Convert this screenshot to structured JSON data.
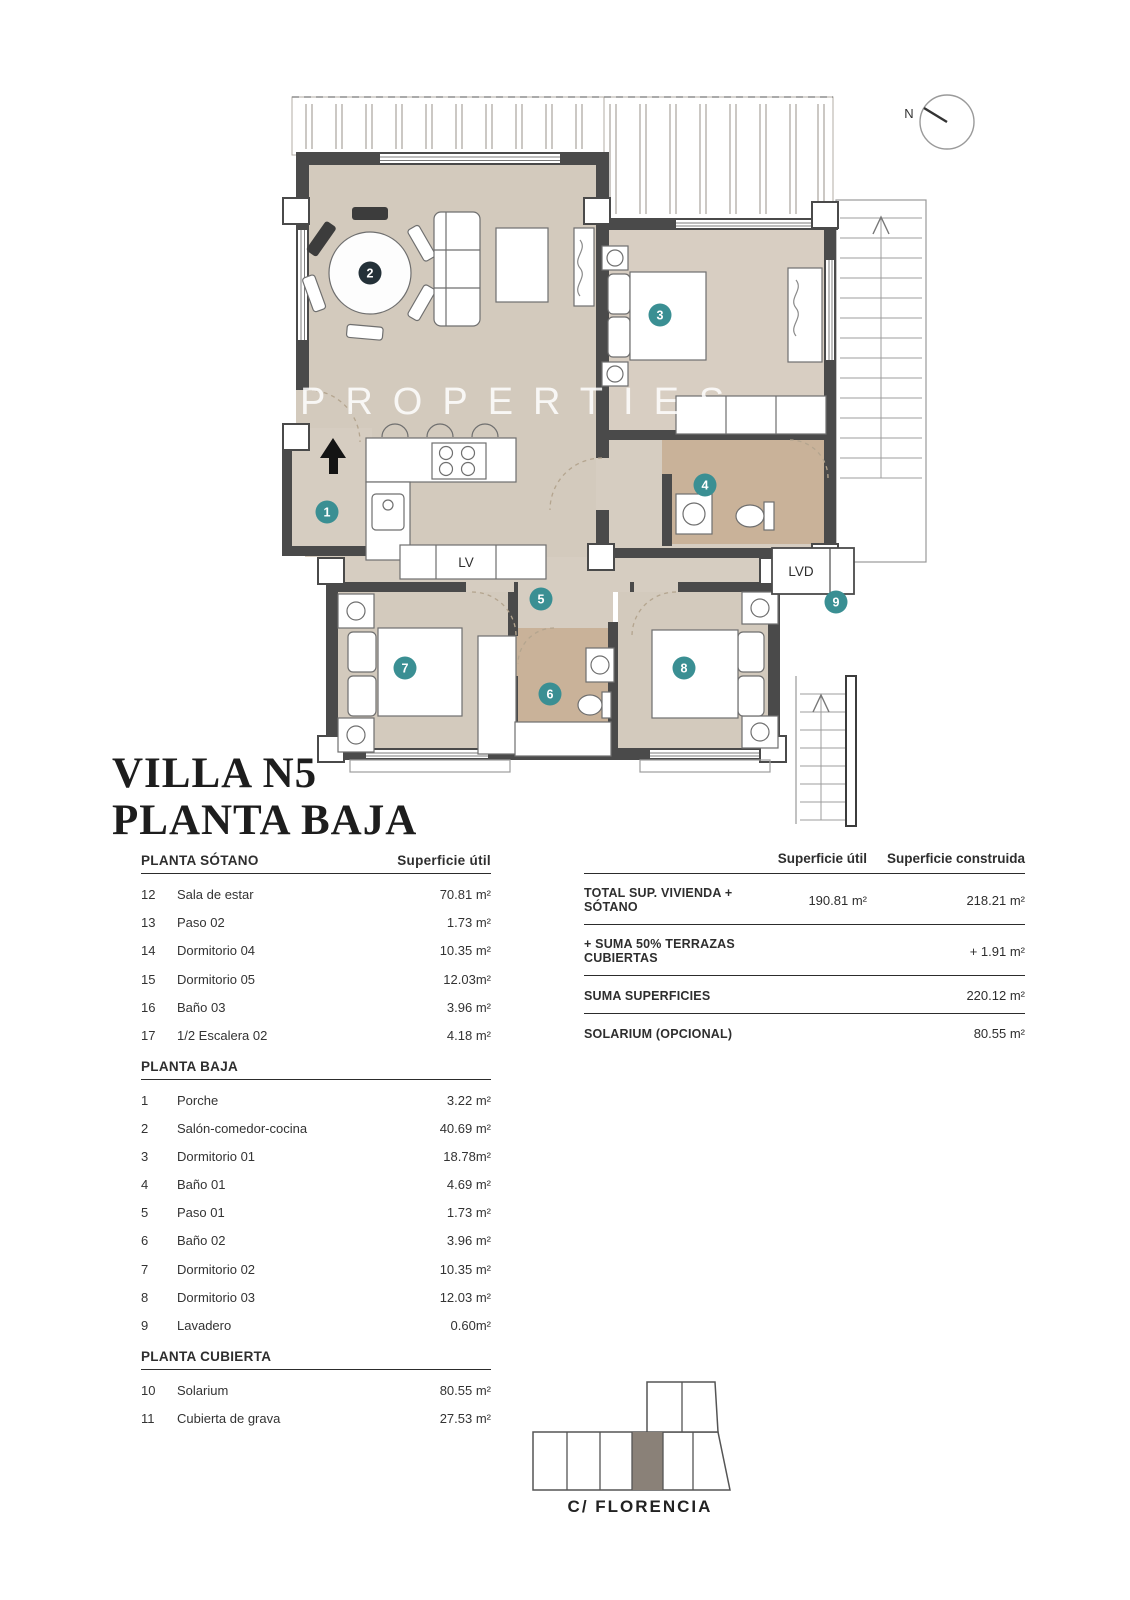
{
  "title": {
    "line1": "VILLA N5",
    "line2": "PLANTA BAJA"
  },
  "watermark": "PROPERTIES",
  "compass": {
    "label": "N"
  },
  "plan": {
    "labels": {
      "lv": "LV",
      "lvd": "LVD"
    },
    "markers": [
      {
        "num": "1",
        "room": "porche"
      },
      {
        "num": "2",
        "room": "salon-comedor-cocina"
      },
      {
        "num": "3",
        "room": "dormitorio-01"
      },
      {
        "num": "4",
        "room": "bano-01"
      },
      {
        "num": "5",
        "room": "paso-01"
      },
      {
        "num": "6",
        "room": "bano-02"
      },
      {
        "num": "7",
        "room": "dormitorio-02"
      },
      {
        "num": "8",
        "room": "dormitorio-03"
      },
      {
        "num": "9",
        "room": "lavadero"
      }
    ]
  },
  "left_table": {
    "sections": [
      {
        "header": "PLANTA SÓTANO",
        "header_right": "Superficie útil",
        "rows": [
          [
            "12",
            "Sala de estar",
            "70.81 m²"
          ],
          [
            "13",
            "Paso 02",
            "1.73 m²"
          ],
          [
            "14",
            "Dormitorio 04",
            "10.35 m²"
          ],
          [
            "15",
            "Dormitorio 05",
            "12.03m²"
          ],
          [
            "16",
            "Baño 03",
            "3.96 m²"
          ],
          [
            "17",
            "1/2 Escalera 02",
            "4.18 m²"
          ]
        ]
      },
      {
        "header": "PLANTA BAJA",
        "rows": [
          [
            "1",
            "Porche",
            "3.22 m²"
          ],
          [
            "2",
            "Salón-comedor-cocina",
            "40.69 m²"
          ],
          [
            "3",
            "Dormitorio 01",
            "18.78m²"
          ],
          [
            "4",
            "Baño 01",
            "4.69 m²"
          ],
          [
            "5",
            "Paso 01",
            "1.73 m²"
          ],
          [
            "6",
            "Baño 02",
            "3.96 m²"
          ],
          [
            "7",
            "Dormitorio 02",
            "10.35 m²"
          ],
          [
            "8",
            "Dormitorio 03",
            "12.03 m²"
          ],
          [
            "9",
            "Lavadero",
            "0.60m²"
          ]
        ]
      },
      {
        "header": "PLANTA CUBIERTA",
        "rows": [
          [
            "10",
            "Solarium",
            "80.55 m²"
          ],
          [
            "11",
            "Cubierta de grava",
            "27.53 m²"
          ]
        ]
      }
    ]
  },
  "summary_table": {
    "col1": "Superficie útil",
    "col2": "Superficie construida",
    "rows": [
      {
        "label": "TOTAL SUP. VIVIENDA + SÓTANO",
        "util": "190.81 m²",
        "construida": "218.21 m²"
      },
      {
        "label": "+ SUMA 50% TERRAZAS CUBIERTAS",
        "construida": "+ 1.91 m²"
      },
      {
        "label": "SUMA SUPERFICIES",
        "construida": "220.12 m²"
      },
      {
        "label": "SOLARIUM (OPCIONAL)",
        "construida": "80.55 m²"
      }
    ]
  },
  "site": {
    "street": "C/ FLORENCIA"
  },
  "colors": {
    "accent_teal": "#3a8f93",
    "marker_dark": "#243138",
    "floor_beige": "#d3cabd",
    "floor_beige_light": "#d8cec2",
    "floor_tan": "#c9b299",
    "floor_hall": "#d6cdc1",
    "wall": "#4a4a4a",
    "site_highlight": "#8a8178"
  }
}
